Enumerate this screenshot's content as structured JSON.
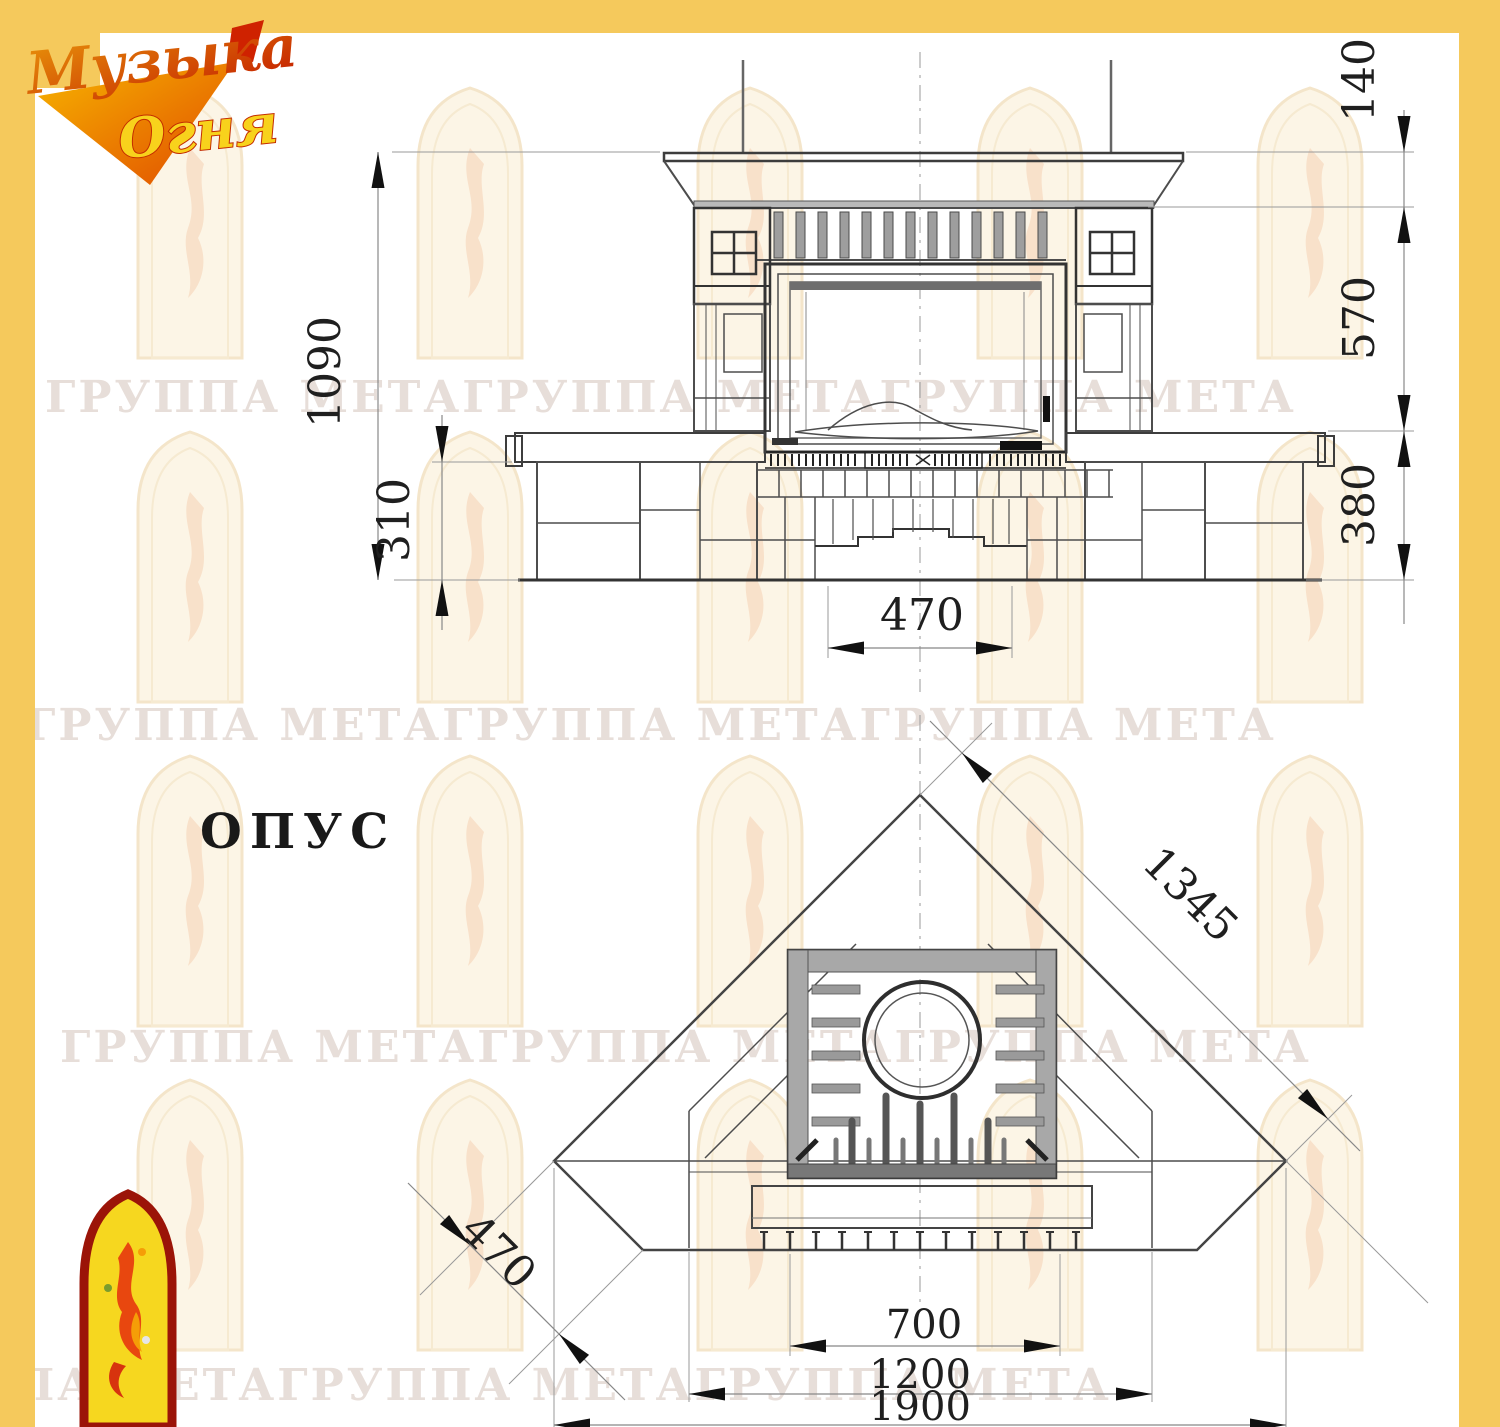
{
  "page": {
    "background": "#ffffff",
    "frame_color": "#f5c95c"
  },
  "brand": {
    "line1": "Музыка",
    "line2": "Огня"
  },
  "model_label": "ОПУС",
  "watermark": {
    "text": "ГРУППА МЕТАГРУППА МЕТАГРУППА МЕТА"
  },
  "front_view": {
    "dimensions": {
      "total_height": "1090",
      "plinth_height": "310",
      "cornice_height": "140",
      "middle_height": "570",
      "bench_height": "380",
      "niche_width": "470"
    }
  },
  "plan_view": {
    "dimensions": {
      "diagonal_width": "1345",
      "side_depth": "470",
      "firebox_width": "700",
      "front_width": "1200",
      "overall_width": "1900"
    }
  },
  "colors": {
    "accent_yellow": "#f5c95c",
    "logo_red": "#cf2200",
    "logo_orange": "#e8820a",
    "icon_yellow": "#f6d71f",
    "icon_border_red": "#9b1408",
    "drawing_line": "#4a4a4a",
    "dimension_text": "#1f1f1f"
  }
}
